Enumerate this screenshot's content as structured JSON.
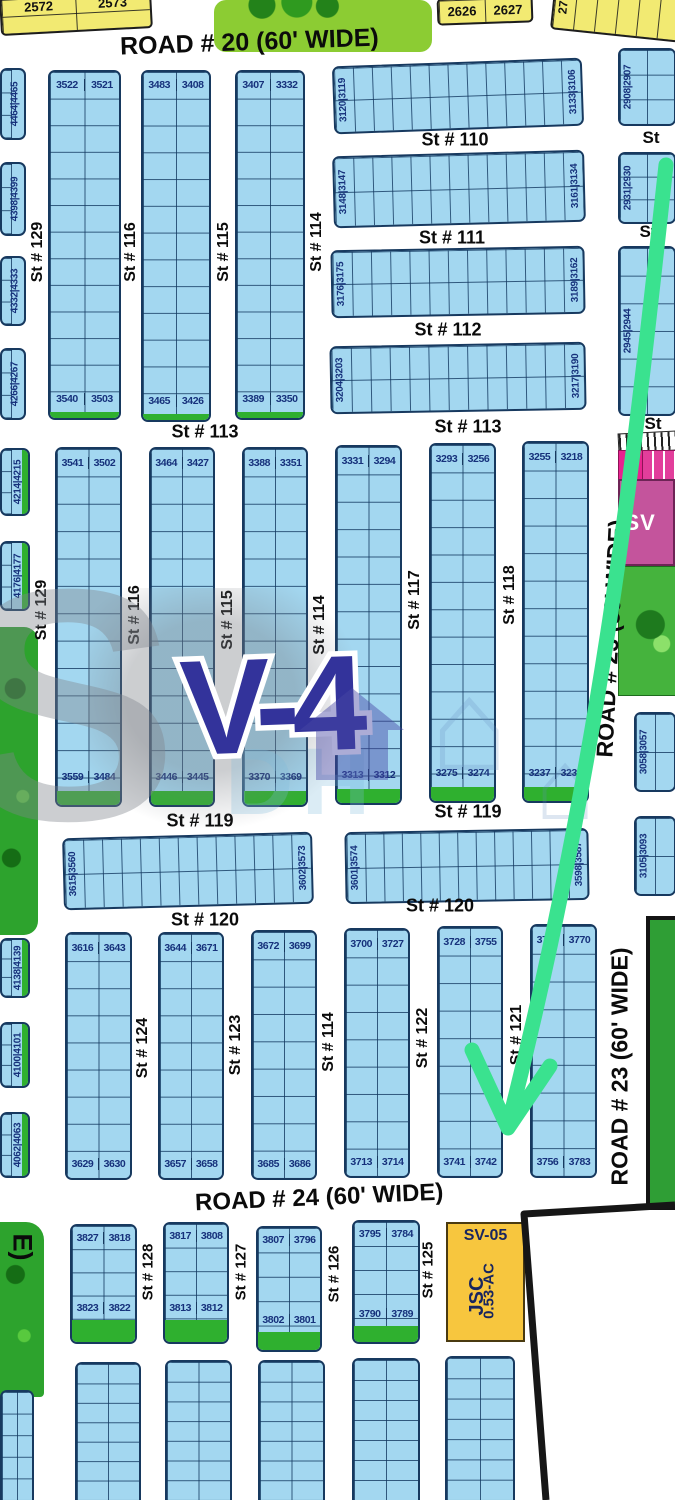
{
  "map": {
    "sector_label": "V-4",
    "arrow_color": "#3ae28f",
    "colors": {
      "plot_fill": "#a3d7f0",
      "plot_line": "#17395f",
      "yellow": "#f2ea72",
      "green": "#2fb02f",
      "park": "#2da32d",
      "magenta": "#c4549c",
      "pink": "#e8238f",
      "orange": "#f7c63e",
      "number_text": "#16317b",
      "boundary": "#161616"
    }
  },
  "roads": {
    "road20": "ROAD # 20 (60' WIDE)",
    "road23": "ROAD # 23 (60' WIDE)",
    "road24": "ROAD # 24 (60' WIDE)",
    "left_fragment": "E)"
  },
  "parcels": {
    "sv05": {
      "name": "SV-05",
      "line2": "JSC",
      "line3": "0.53-AC"
    },
    "sv_right": "SV",
    "strip_168": "168"
  },
  "watermark": {
    "ghost1": "S",
    "ghost2": "DH",
    "house_glyph": "⌂"
  },
  "yellow_blocks": [
    {
      "x": 0,
      "y": -6,
      "w": 152,
      "h": 38,
      "rot": -3,
      "cells": [
        "2572",
        "2573"
      ],
      "cols": 2,
      "rows": 2
    },
    {
      "x": 437,
      "y": -3,
      "w": 96,
      "h": 27,
      "rot": -2,
      "cells": [
        "2626",
        "2627"
      ],
      "cols": 2,
      "rows": 1
    },
    {
      "x": 552,
      "y": -10,
      "w": 130,
      "h": 46,
      "rot": 6,
      "vlabel": "27",
      "cols": 6,
      "rows": 1
    }
  ],
  "plot_blocks": [
    {
      "kind": "vcol",
      "x": 48,
      "y": 70,
      "w": 73,
      "h": 350,
      "rows": 13,
      "top": [
        "3522",
        "3521"
      ],
      "bottom": [
        "3540",
        "3503"
      ],
      "green": true,
      "greenH": 6
    },
    {
      "kind": "vcol",
      "x": 141,
      "y": 70,
      "w": 70,
      "h": 352,
      "rows": 13,
      "top": [
        "3483",
        "3408"
      ],
      "bottom": [
        "3465",
        "3426"
      ],
      "green": true,
      "greenH": 6
    },
    {
      "kind": "vcol",
      "x": 235,
      "y": 70,
      "w": 70,
      "h": 350,
      "rows": 13,
      "top": [
        "3407",
        "3332"
      ],
      "bottom": [
        "3389",
        "3350"
      ],
      "green": true,
      "greenH": 6
    },
    {
      "kind": "hrow",
      "x": 333,
      "y": 62,
      "w": 250,
      "h": 68,
      "cols": 13,
      "rot": -2,
      "left": [
        "3120",
        "3119"
      ],
      "right": [
        "3133",
        "3106"
      ]
    },
    {
      "kind": "hrow",
      "x": 333,
      "y": 153,
      "w": 252,
      "h": 72,
      "cols": 13,
      "rot": -1.5,
      "left": [
        "3148",
        "3147"
      ],
      "right": [
        "3161",
        "3134"
      ]
    },
    {
      "kind": "hrow",
      "x": 331,
      "y": 248,
      "w": 254,
      "h": 68,
      "cols": 13,
      "rot": -1,
      "left": [
        "3176",
        "3175"
      ],
      "right": [
        "3189",
        "3162"
      ]
    },
    {
      "kind": "hrow",
      "x": 330,
      "y": 344,
      "w": 256,
      "h": 68,
      "cols": 13,
      "rot": -1,
      "left": [
        "3204",
        "3203"
      ],
      "right": [
        "3217",
        "3190"
      ]
    },
    {
      "kind": "hrow",
      "x": 618,
      "y": 48,
      "w": 58,
      "h": 78,
      "cols": 2,
      "rows": 3,
      "left": [
        "2908",
        "2907"
      ]
    },
    {
      "kind": "hrow",
      "x": 618,
      "y": 152,
      "w": 58,
      "h": 72,
      "cols": 2,
      "rows": 3,
      "left": [
        "2931",
        "2930"
      ]
    },
    {
      "kind": "hrow",
      "x": 618,
      "y": 246,
      "w": 58,
      "h": 170,
      "cols": 2,
      "rows": 6,
      "left": [
        "2945",
        "2944"
      ]
    },
    {
      "kind": "vcol",
      "x": 55,
      "y": 447,
      "w": 67,
      "h": 360,
      "rows": 13,
      "top": [
        "3541",
        "3502"
      ],
      "bottom": [
        "3559",
        "3484"
      ],
      "green": true,
      "greenH": 14
    },
    {
      "kind": "vcol",
      "x": 149,
      "y": 447,
      "w": 66,
      "h": 360,
      "rows": 13,
      "top": [
        "3464",
        "3427"
      ],
      "bottom": [
        "3446",
        "3445"
      ],
      "green": true,
      "greenH": 14
    },
    {
      "kind": "vcol",
      "x": 242,
      "y": 447,
      "w": 66,
      "h": 360,
      "rows": 13,
      "top": [
        "3388",
        "3351"
      ],
      "bottom": [
        "3370",
        "3369"
      ],
      "green": true,
      "greenH": 14
    },
    {
      "kind": "vcol",
      "x": 335,
      "y": 445,
      "w": 67,
      "h": 360,
      "rows": 13,
      "top": [
        "3331",
        "3294"
      ],
      "bottom": [
        "3313",
        "3312"
      ],
      "green": true,
      "greenH": 14
    },
    {
      "kind": "vcol",
      "x": 429,
      "y": 443,
      "w": 67,
      "h": 360,
      "rows": 13,
      "top": [
        "3293",
        "3256"
      ],
      "bottom": [
        "3275",
        "3274"
      ],
      "green": true,
      "greenH": 14
    },
    {
      "kind": "vcol",
      "x": 522,
      "y": 441,
      "w": 67,
      "h": 362,
      "rows": 13,
      "top": [
        "3255",
        "3218"
      ],
      "bottom": [
        "3237",
        "3236"
      ],
      "green": true,
      "greenH": 14
    },
    {
      "kind": "hrow",
      "x": 63,
      "y": 835,
      "w": 250,
      "h": 72,
      "cols": 13,
      "rot": -1.5,
      "left": [
        "3615",
        "3560"
      ],
      "right": [
        "3602",
        "3573"
      ]
    },
    {
      "kind": "hrow",
      "x": 345,
      "y": 830,
      "w": 244,
      "h": 72,
      "cols": 13,
      "rot": -1,
      "left": [
        "3601",
        "3574"
      ],
      "right": [
        "3598",
        "3587"
      ]
    },
    {
      "kind": "hrow",
      "x": 634,
      "y": 712,
      "w": 42,
      "h": 80,
      "cols": 2,
      "rows": 2,
      "left": [
        "3058",
        "3057"
      ]
    },
    {
      "kind": "hrow",
      "x": 634,
      "y": 816,
      "w": 42,
      "h": 80,
      "cols": 2,
      "rows": 2,
      "left": [
        "3105",
        "3093"
      ]
    },
    {
      "kind": "vcol",
      "x": 65,
      "y": 932,
      "w": 67,
      "h": 248,
      "rows": 9,
      "top": [
        "3616",
        "3643"
      ],
      "bottom": [
        "3629",
        "3630"
      ]
    },
    {
      "kind": "vcol",
      "x": 158,
      "y": 932,
      "w": 66,
      "h": 248,
      "rows": 9,
      "top": [
        "3644",
        "3671"
      ],
      "bottom": [
        "3657",
        "3658"
      ]
    },
    {
      "kind": "vcol",
      "x": 251,
      "y": 930,
      "w": 66,
      "h": 250,
      "rows": 9,
      "top": [
        "3672",
        "3699"
      ],
      "bottom": [
        "3685",
        "3686"
      ]
    },
    {
      "kind": "vcol",
      "x": 344,
      "y": 928,
      "w": 66,
      "h": 250,
      "rows": 9,
      "top": [
        "3700",
        "3727"
      ],
      "bottom": [
        "3713",
        "3714"
      ]
    },
    {
      "kind": "vcol",
      "x": 437,
      "y": 926,
      "w": 66,
      "h": 252,
      "rows": 9,
      "top": [
        "3728",
        "3755"
      ],
      "bottom": [
        "3741",
        "3742"
      ]
    },
    {
      "kind": "vcol",
      "x": 530,
      "y": 924,
      "w": 67,
      "h": 254,
      "rows": 9,
      "top": [
        "3769",
        "3770"
      ],
      "bottom": [
        "3756",
        "3783"
      ]
    },
    {
      "kind": "vcol",
      "x": 70,
      "y": 1224,
      "w": 67,
      "h": 120,
      "rows": 5,
      "top": [
        "3827",
        "3818"
      ],
      "bottom": [
        "3823",
        "3822"
      ],
      "green": true,
      "greenH": 22
    },
    {
      "kind": "vcol",
      "x": 163,
      "y": 1222,
      "w": 66,
      "h": 122,
      "rows": 5,
      "top": [
        "3817",
        "3808"
      ],
      "bottom": [
        "3813",
        "3812"
      ],
      "green": true,
      "greenH": 22
    },
    {
      "kind": "vcol",
      "x": 256,
      "y": 1226,
      "w": 66,
      "h": 126,
      "rows": 5,
      "top": [
        "3807",
        "3796"
      ],
      "bottom": [
        "3802",
        "3801"
      ],
      "green": true,
      "greenH": 18
    },
    {
      "kind": "vcol",
      "x": 352,
      "y": 1220,
      "w": 68,
      "h": 124,
      "rows": 5,
      "top": [
        "3795",
        "3784"
      ],
      "bottom": [
        "3790",
        "3789"
      ],
      "green": true,
      "greenH": 16
    }
  ],
  "side_blocks": [
    {
      "pair": [
        "4464",
        "4465"
      ],
      "x": 0,
      "y": 68,
      "w": 26,
      "h": 72
    },
    {
      "pair": [
        "4398",
        "4399"
      ],
      "x": 0,
      "y": 162,
      "w": 26,
      "h": 74
    },
    {
      "pair": [
        "4332",
        "4333"
      ],
      "x": 0,
      "y": 256,
      "w": 26,
      "h": 70
    },
    {
      "pair": [
        "4266",
        "4267"
      ],
      "x": 0,
      "y": 348,
      "w": 26,
      "h": 72
    },
    {
      "pair": [
        "4214",
        "4215"
      ],
      "x": 0,
      "y": 448,
      "w": 30,
      "h": 68,
      "green": true
    },
    {
      "pair": [
        "4176",
        "4177"
      ],
      "x": 0,
      "y": 541,
      "w": 30,
      "h": 70,
      "green": true
    },
    {
      "pair": [
        "4138",
        "4139"
      ],
      "x": 0,
      "y": 938,
      "w": 30,
      "h": 60,
      "green": true
    },
    {
      "pair": [
        "4100",
        "4101"
      ],
      "x": 0,
      "y": 1022,
      "w": 30,
      "h": 66,
      "green": true
    },
    {
      "pair": [
        "4062",
        "4063"
      ],
      "x": 0,
      "y": 1112,
      "w": 30,
      "h": 66,
      "green": true
    }
  ],
  "plain_grids": [
    {
      "x": 75,
      "y": 1362,
      "w": 66,
      "h": 138,
      "cols": 2,
      "rows": 7
    },
    {
      "x": 165,
      "y": 1360,
      "w": 67,
      "h": 140,
      "cols": 2,
      "rows": 7
    },
    {
      "x": 258,
      "y": 1360,
      "w": 67,
      "h": 140,
      "cols": 2,
      "rows": 7
    },
    {
      "x": 352,
      "y": 1358,
      "w": 68,
      "h": 142,
      "cols": 2,
      "rows": 7
    },
    {
      "x": 445,
      "y": 1356,
      "w": 70,
      "h": 144,
      "cols": 2,
      "rows": 7
    },
    {
      "x": 0,
      "y": 1390,
      "w": 34,
      "h": 110,
      "cols": 2,
      "rows": 5
    }
  ],
  "street_labels": [
    {
      "t": "St # 129",
      "x": 38,
      "y": 252,
      "v": true,
      "s": 16
    },
    {
      "t": "St # 116",
      "x": 131,
      "y": 252,
      "v": true,
      "s": 16
    },
    {
      "t": "St # 115",
      "x": 224,
      "y": 252,
      "v": true,
      "s": 16
    },
    {
      "t": "St # 114",
      "x": 317,
      "y": 242,
      "v": true,
      "s": 16
    },
    {
      "t": "St # 110",
      "x": 455,
      "y": 140,
      "v": false,
      "s": 18
    },
    {
      "t": "St # 111",
      "x": 452,
      "y": 238,
      "v": false,
      "s": 18
    },
    {
      "t": "St # 112",
      "x": 448,
      "y": 330,
      "v": false,
      "s": 18
    },
    {
      "t": "St # 113",
      "x": 205,
      "y": 432,
      "v": false,
      "s": 18
    },
    {
      "t": "St # 113",
      "x": 468,
      "y": 427,
      "v": false,
      "s": 18
    },
    {
      "t": "St",
      "x": 651,
      "y": 138,
      "v": false,
      "s": 17
    },
    {
      "t": "St",
      "x": 648,
      "y": 232,
      "v": false,
      "s": 17
    },
    {
      "t": "St",
      "x": 653,
      "y": 424,
      "v": false,
      "s": 17
    },
    {
      "t": "St # 129",
      "x": 42,
      "y": 610,
      "v": true,
      "s": 16
    },
    {
      "t": "St # 116",
      "x": 135,
      "y": 615,
      "v": true,
      "s": 16
    },
    {
      "t": "St # 115",
      "x": 228,
      "y": 620,
      "v": true,
      "s": 16
    },
    {
      "t": "St # 114",
      "x": 320,
      "y": 625,
      "v": true,
      "s": 16
    },
    {
      "t": "St # 117",
      "x": 415,
      "y": 600,
      "v": true,
      "s": 16
    },
    {
      "t": "St # 118",
      "x": 510,
      "y": 595,
      "v": true,
      "s": 16
    },
    {
      "t": "St # 119",
      "x": 200,
      "y": 821,
      "v": false,
      "s": 18
    },
    {
      "t": "St # 119",
      "x": 468,
      "y": 812,
      "v": false,
      "s": 18
    },
    {
      "t": "St # 120",
      "x": 205,
      "y": 920,
      "v": false,
      "s": 18
    },
    {
      "t": "St # 120",
      "x": 440,
      "y": 906,
      "v": false,
      "s": 18
    },
    {
      "t": "St # 124",
      "x": 143,
      "y": 1048,
      "v": true,
      "s": 16
    },
    {
      "t": "St # 123",
      "x": 236,
      "y": 1045,
      "v": true,
      "s": 16
    },
    {
      "t": "St # 114",
      "x": 329,
      "y": 1042,
      "v": true,
      "s": 16
    },
    {
      "t": "St # 122",
      "x": 423,
      "y": 1038,
      "v": true,
      "s": 16
    },
    {
      "t": "St # 121",
      "x": 517,
      "y": 1035,
      "v": true,
      "s": 16
    },
    {
      "t": "St # 128",
      "x": 148,
      "y": 1272,
      "v": true,
      "s": 15
    },
    {
      "t": "St # 127",
      "x": 241,
      "y": 1272,
      "v": true,
      "s": 15
    },
    {
      "t": "St # 126",
      "x": 334,
      "y": 1274,
      "v": true,
      "s": 15
    },
    {
      "t": "St # 125",
      "x": 428,
      "y": 1270,
      "v": true,
      "s": 15
    }
  ]
}
